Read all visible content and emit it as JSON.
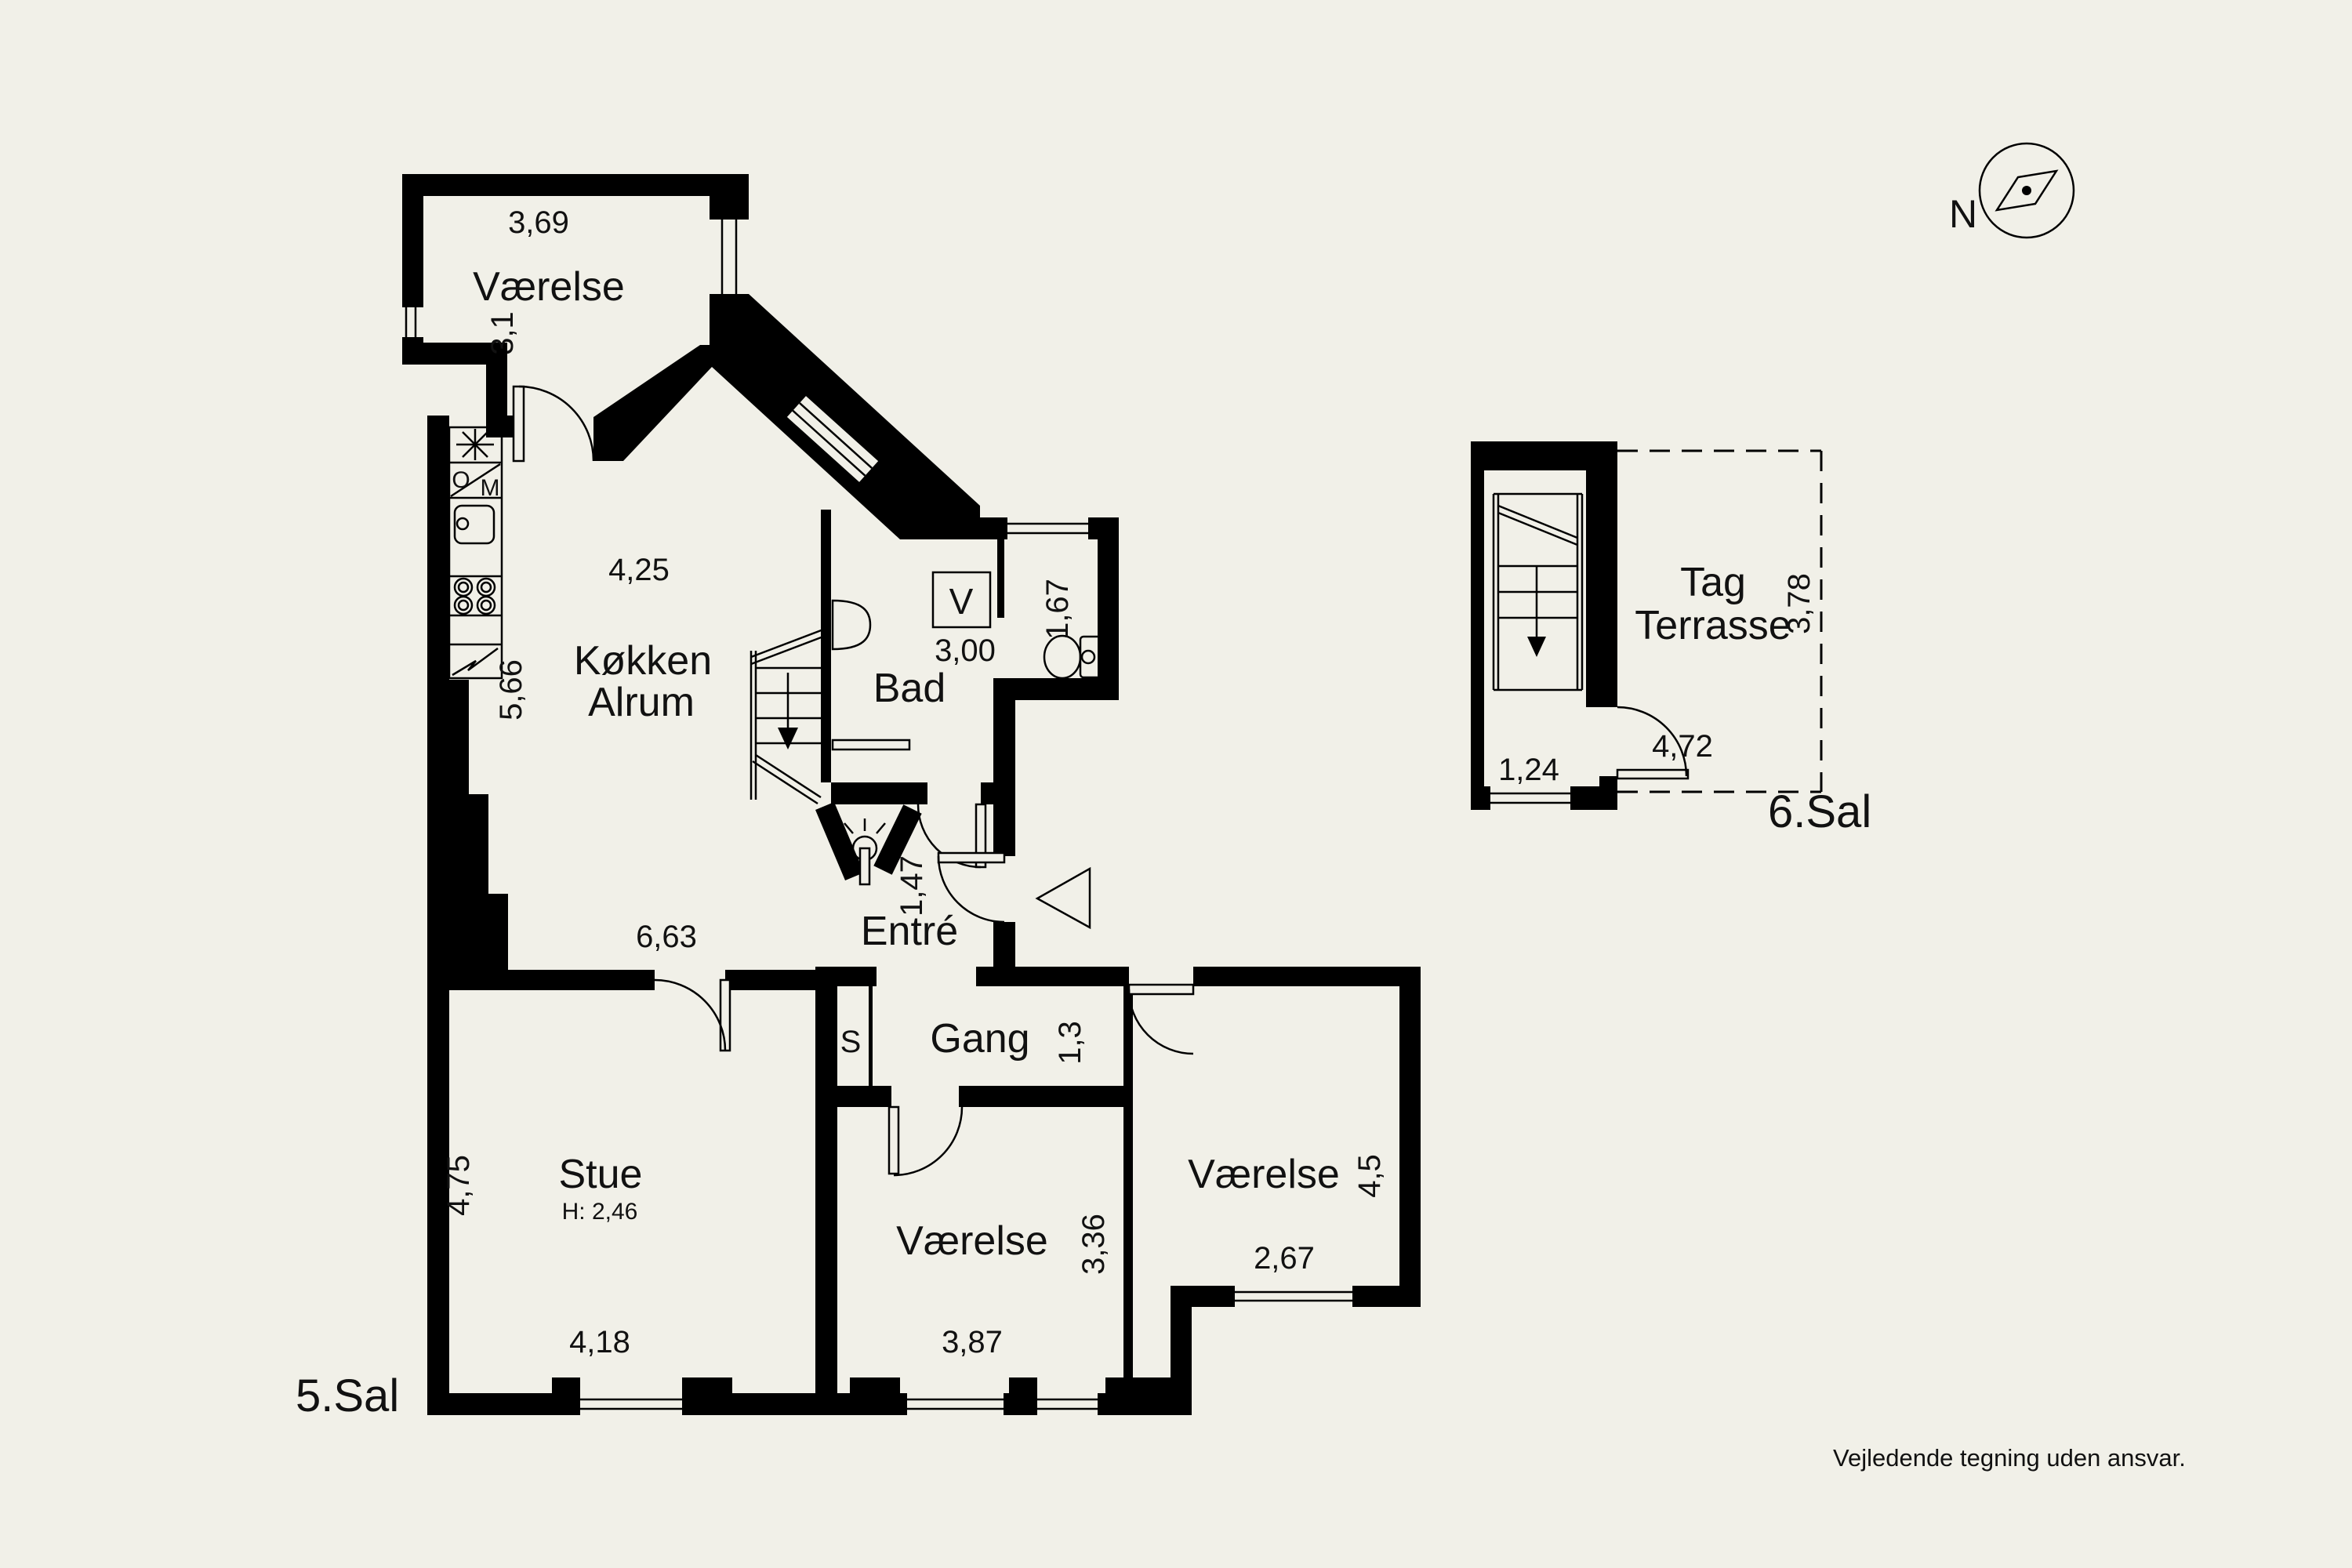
{
  "colors": {
    "background": "#f1f0e8",
    "walls": "#000000",
    "text": "#111111"
  },
  "floor5": {
    "label": "5.Sal",
    "bedroom_north": {
      "name": "Værelse",
      "width": "3,69",
      "depth": "3,1"
    },
    "kitchen": {
      "name_line1": "Køkken",
      "name_line2": "Alrum",
      "width": "4,25",
      "depth": "5,66",
      "lower_width": "6,63",
      "oven_letter": "O",
      "micro_letter": "M"
    },
    "bath": {
      "name": "Bad",
      "width": "3,00",
      "wc_depth": "1,67",
      "washer_letter": "V"
    },
    "entry": {
      "name": "Entré",
      "depth": "1,47"
    },
    "hall": {
      "name": "Gang",
      "depth": "1,3",
      "closet_letter": "S"
    },
    "living": {
      "name": "Stue",
      "ceiling_height": "H: 2,46",
      "depth": "4,75",
      "width": "4,18"
    },
    "bedroom_mid": {
      "name": "Værelse",
      "width": "3,87",
      "depth": "3,36"
    },
    "bedroom_east": {
      "name": "Værelse",
      "depth": "4,5",
      "width": "2,67"
    }
  },
  "floor6": {
    "label": "6.Sal",
    "terrace": {
      "name_line1": "Tag",
      "name_line2": "Terrasse",
      "depth": "3,78",
      "width": "4,72"
    },
    "stair_width": "1,24"
  },
  "compass": {
    "north_label": "N"
  },
  "disclaimer": "Vejledende tegning uden ansvar."
}
